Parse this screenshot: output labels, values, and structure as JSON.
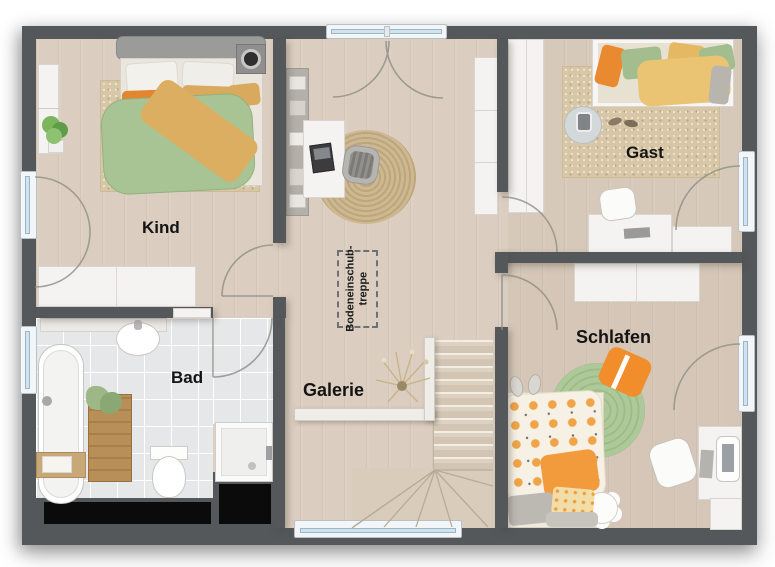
{
  "rooms": {
    "kind": {
      "label": "Kind"
    },
    "gast": {
      "label": "Gast"
    },
    "bad": {
      "label": "Bad"
    },
    "galerie": {
      "label": "Galerie"
    },
    "schlafen": {
      "label": "Schlafen"
    }
  },
  "annotation": {
    "line1": "Bodeneinschub-",
    "line2": "treppe"
  },
  "colors": {
    "wall": "#54585b",
    "floor_wood": "#dbcec0",
    "floor_tile": "#e6e7e9",
    "window_glass": "#cfe3f0",
    "accent_orange": "#ef8e2e",
    "accent_green": "#a9c693",
    "void_black": "#0b0b0b"
  }
}
